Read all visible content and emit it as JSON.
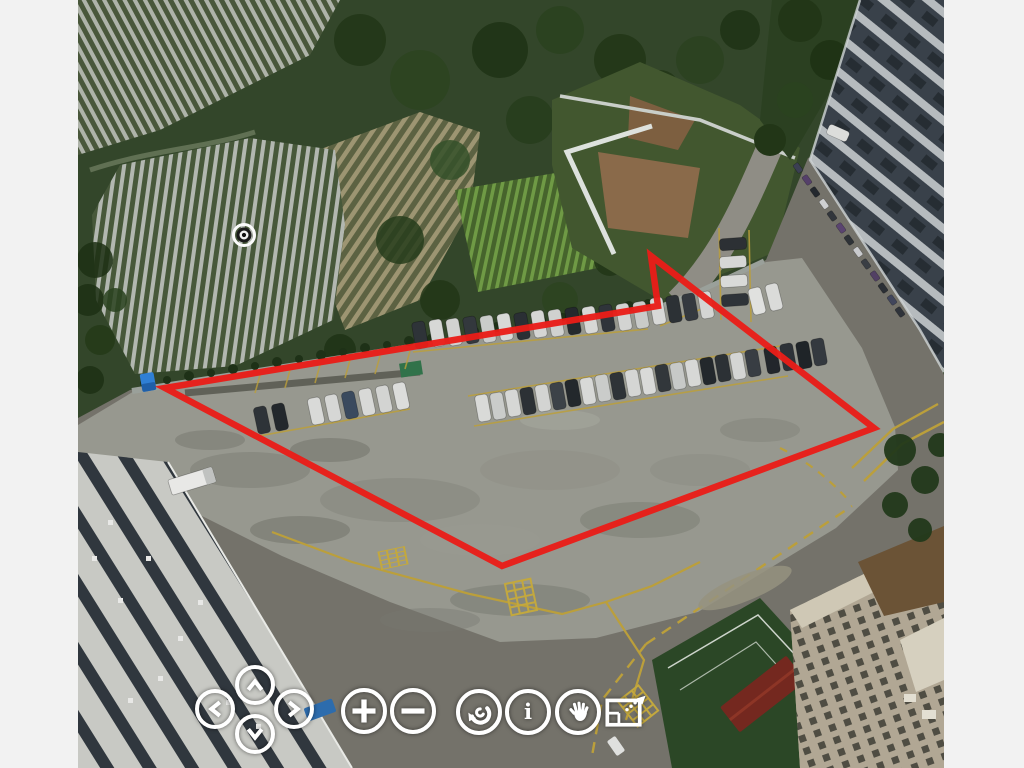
{
  "app": {
    "name": "aerial-panorama-viewer",
    "background_color": "#f2f2f2"
  },
  "scene": {
    "description": "Aerial drone photo: fenced concrete parking lot with three rows of parked cars, farmland with mulched crop rows top-left, dense green vegetation and walled garden top-center, high-rise building with parked cars along it on the right, striped industrial roof bottom-left, apartment blocks, red-roofed shed and green sports field bottom-right.",
    "photo_area": {
      "left": 78,
      "top": 0,
      "width": 866,
      "height": 768
    }
  },
  "annotation": {
    "type": "polygon",
    "color": "#e91d18",
    "stroke_width": 6.5,
    "points": "165,388 658,306 651,256 874,428 502,566"
  },
  "hotspot": {
    "name": "target-hotspot",
    "x": 244,
    "y": 235,
    "transform": "translate(244 235)"
  },
  "marker": {
    "name": "blue-marker",
    "x": 148,
    "y": 382,
    "color": "#2f7fd4",
    "transform": "translate(148 382) rotate(-10)"
  },
  "controls": {
    "pan_up": {
      "label": "Pan up",
      "icon": "chevron-up"
    },
    "pan_down": {
      "label": "Pan down",
      "icon": "chevron-down"
    },
    "pan_left": {
      "label": "Pan left",
      "icon": "chevron-left"
    },
    "pan_right": {
      "label": "Pan right",
      "icon": "chevron-right"
    },
    "zoom_in": {
      "label": "Zoom in",
      "icon": "plus"
    },
    "zoom_out": {
      "label": "Zoom out",
      "icon": "minus"
    },
    "rotate": {
      "label": "Auto rotate",
      "icon": "circular-arrow"
    },
    "info": {
      "label": "Information",
      "icon": "info-i",
      "glyph": "i"
    },
    "pan_mode": {
      "label": "Drag to pan",
      "icon": "hand"
    },
    "fullscreen": {
      "label": "Fullscreen",
      "icon": "screen-arrow"
    }
  },
  "colors": {
    "annotation_red": "#e91d18",
    "road_marking_yellow": "#bb9f3b",
    "control_white": "#ffffff",
    "concrete": "#97988f",
    "asphalt": "#74726a"
  }
}
